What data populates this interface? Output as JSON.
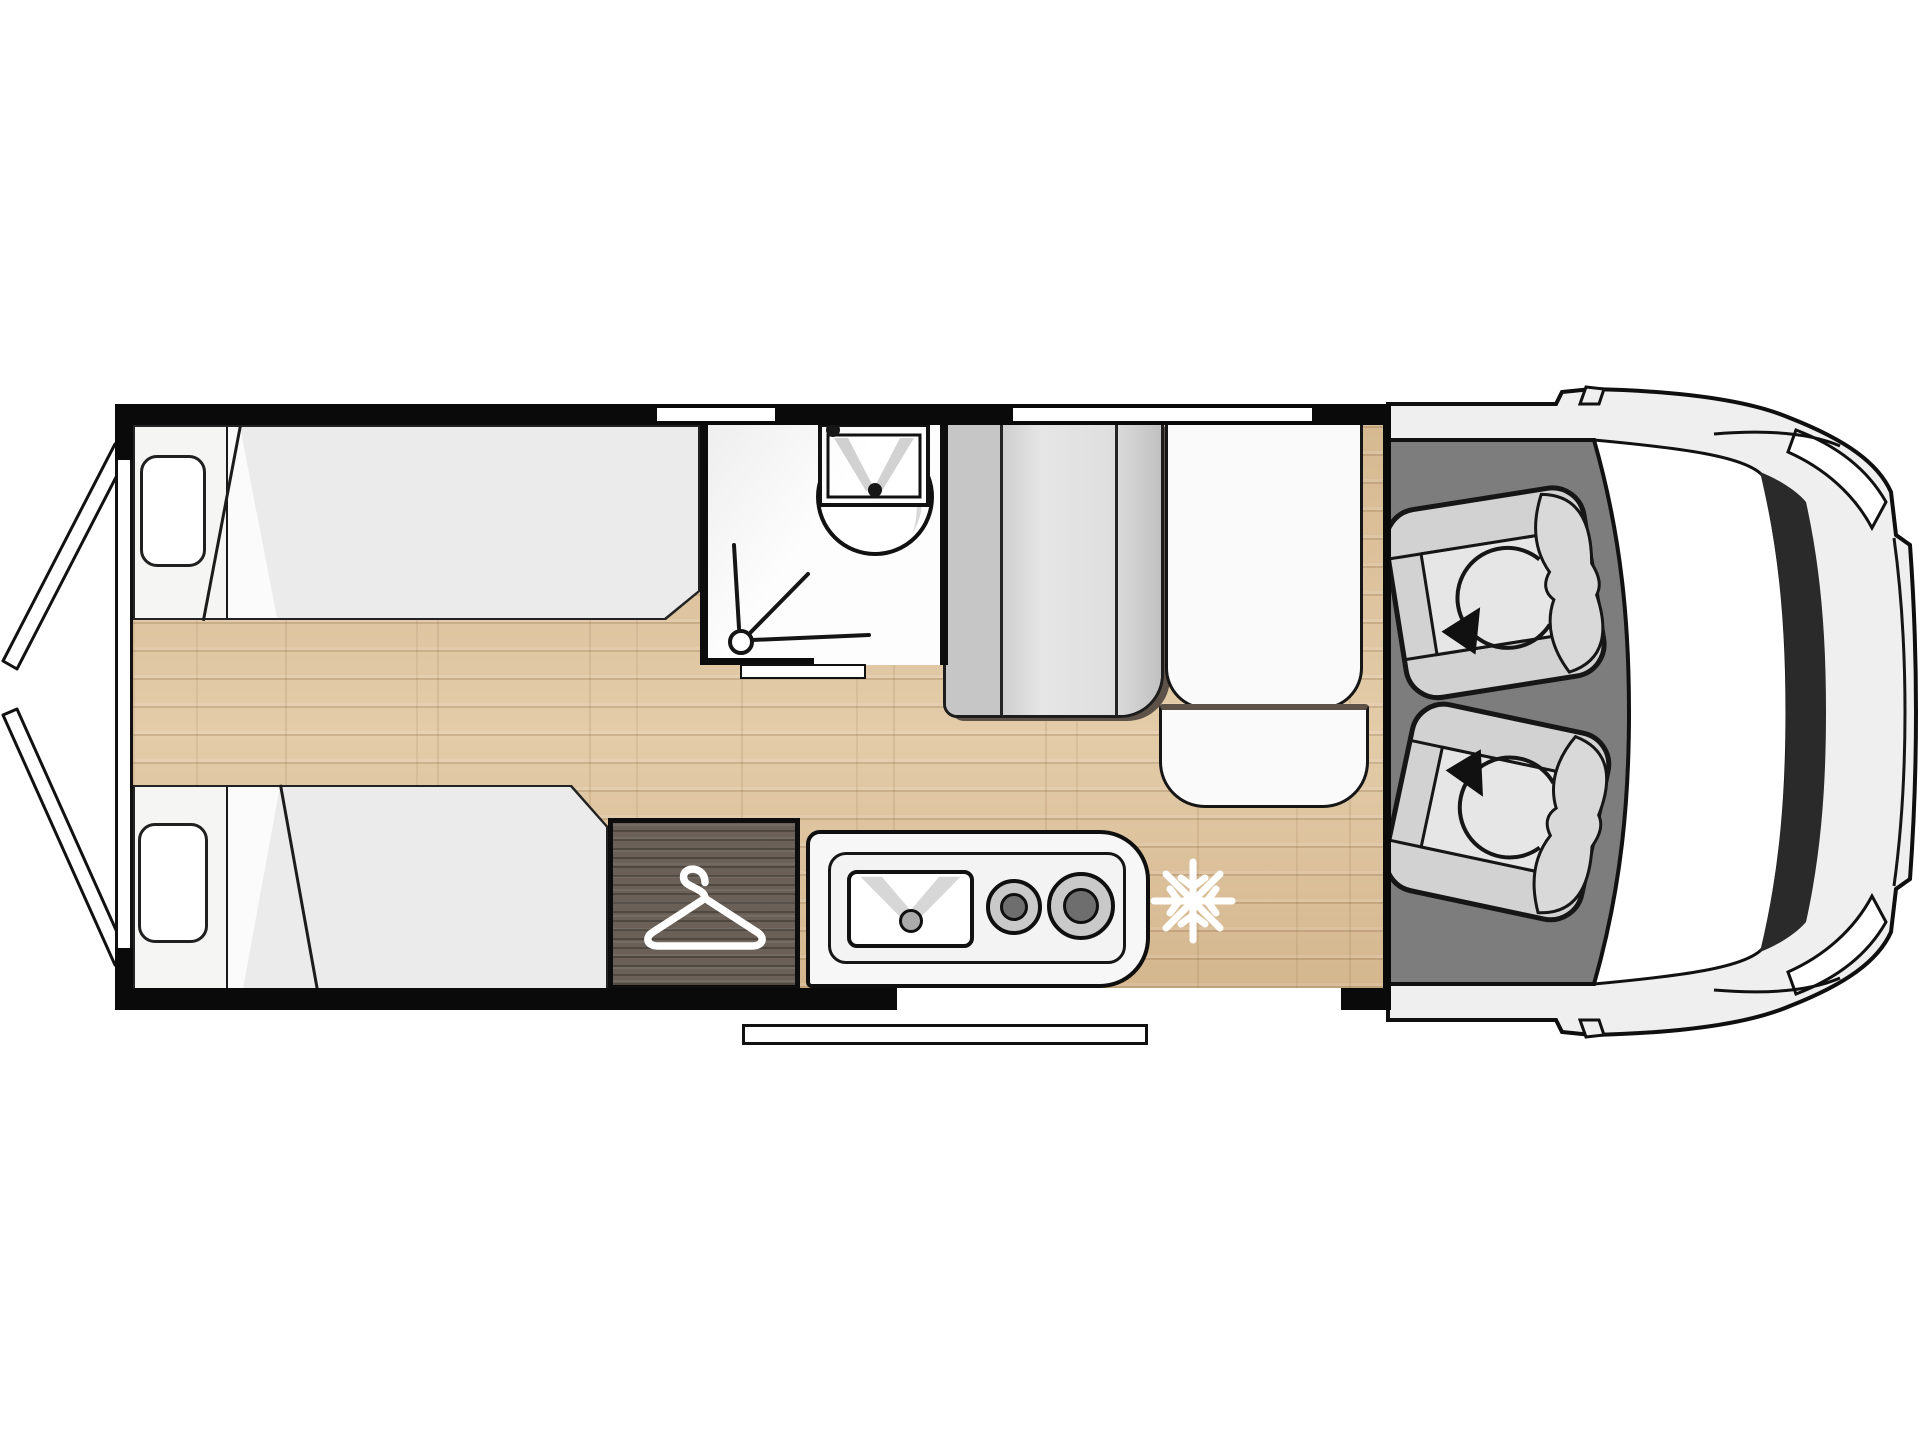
{
  "meta": {
    "title": "Campervan floor plan - top view",
    "type": "vehicle-floorplan",
    "orientation": "front-right rear-left"
  },
  "colors": {
    "white": "#ffffff",
    "wall": "#0a0a0a",
    "outline": "#141414",
    "wood": "#dcc19b",
    "mattress": "#ebebeb",
    "headboard": "#f5f5f3",
    "pillow": "#ffffff",
    "bathroom": "#fdfdfd",
    "cabinet_left": "#c6c6c6",
    "cabinet_mid": "#e2e2e2",
    "cabinet_right": "#cfcfcf",
    "bench": "#fafafa",
    "trim_brown": "#5c5248",
    "dark_wood": "#6a6057",
    "counter": "#f7f7f7",
    "sink": "#ffffff",
    "sink_shadow": "#d7d7d7",
    "drain": "#ababab",
    "burner_ring": "#c9c9c9",
    "burner_center": "#6e6e6e",
    "snowflake": "#ffffff",
    "hanger": "#ffffff",
    "cab_floor": "#7d7d7d",
    "seat": "#d2d2d2",
    "seat_pad": "#e6e6e6",
    "seat_back": "#d9d9d9",
    "body": "#efefef",
    "windshield": "#2a2a2a",
    "dashboard": "#ffffff",
    "headlight": "#ffffff",
    "door_panel": "#ffffff",
    "step": "#ffffff"
  },
  "features": {
    "rear_doors": {
      "name": "rear-doors-open",
      "count": 2
    },
    "beds": {
      "count": 2,
      "layout": "twin-longitudinal",
      "pillows": 2
    },
    "bathroom": {
      "washbasin": 1,
      "shower_drain": 1,
      "sliding_door": 1
    },
    "closet": {
      "icon": "hanger-icon"
    },
    "kitchen": {
      "sink": 1,
      "burners": 2
    },
    "refrigerator": {
      "icon": "snowflake-icon"
    },
    "cab": {
      "seats": 2,
      "swivel": true,
      "icon": "rotate-arrow-icon"
    },
    "van_front": {
      "windshield": 1,
      "headlights": 2,
      "mirrors": 2
    },
    "windows": {
      "count": 2
    },
    "entry_step": {
      "count": 1
    }
  }
}
